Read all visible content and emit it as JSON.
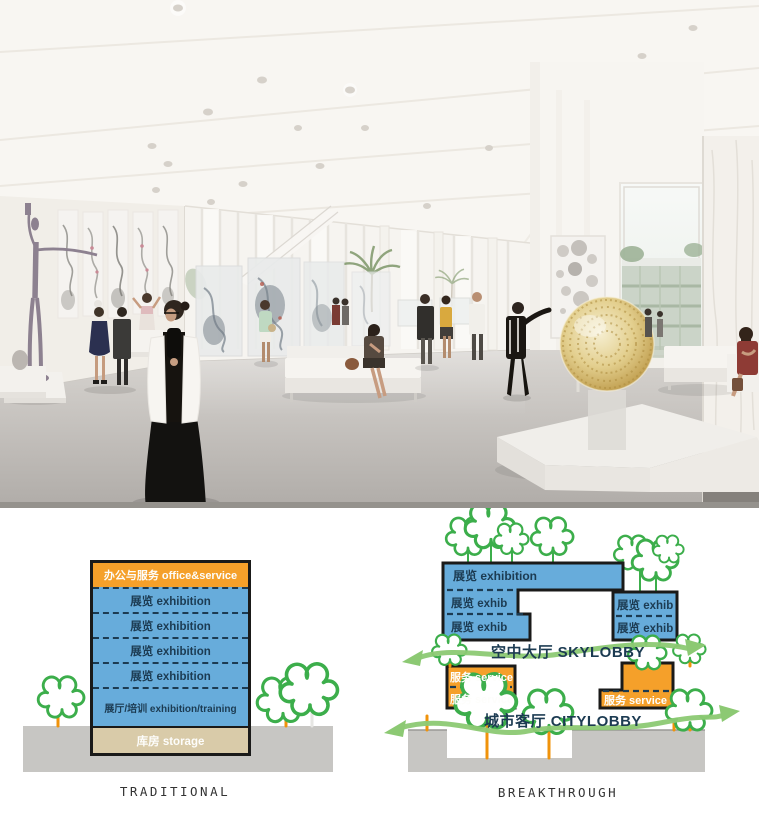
{
  "colors": {
    "blue": "#67ACDB",
    "orange": "#F5A02A",
    "tan": "#D9CBA9",
    "navy": "#1C3B52",
    "outline": "#1A1A19",
    "ground": "#C7C6C3",
    "tree": "#3CAE4B",
    "trunk": "#F0930B",
    "swoosh": "#8CC973",
    "caption": "#333333",
    "gold": "#D9C179"
  },
  "diagrams": {
    "traditional": {
      "caption": "TRADITIONAL",
      "floors": [
        {
          "label": "办公与服务 office&service"
        },
        {
          "label": "展览 exhibition"
        },
        {
          "label": "展览 exhibition"
        },
        {
          "label": "展览 exhibition"
        },
        {
          "label": "展览 exhibition"
        },
        {
          "label": "展厅/培训 exhibition/training"
        },
        {
          "label": "库房 storage"
        }
      ]
    },
    "breakthrough": {
      "caption": "BREAKTHROUGH",
      "exhibition_top": "展览 exhibition",
      "exhib_left_1": "展览 exhib",
      "exhib_left_2": "展览 exhib",
      "exhib_right_1": "展览 exhib",
      "exhib_right_2": "展览 exhib",
      "skylobby": "空中大厅 SKYLOBBY",
      "citylobby": "城市客厅 CITYLOBBY",
      "service_left_1": "服务 service",
      "service_left_2": "服务 service",
      "service_right": "服务 service"
    }
  }
}
